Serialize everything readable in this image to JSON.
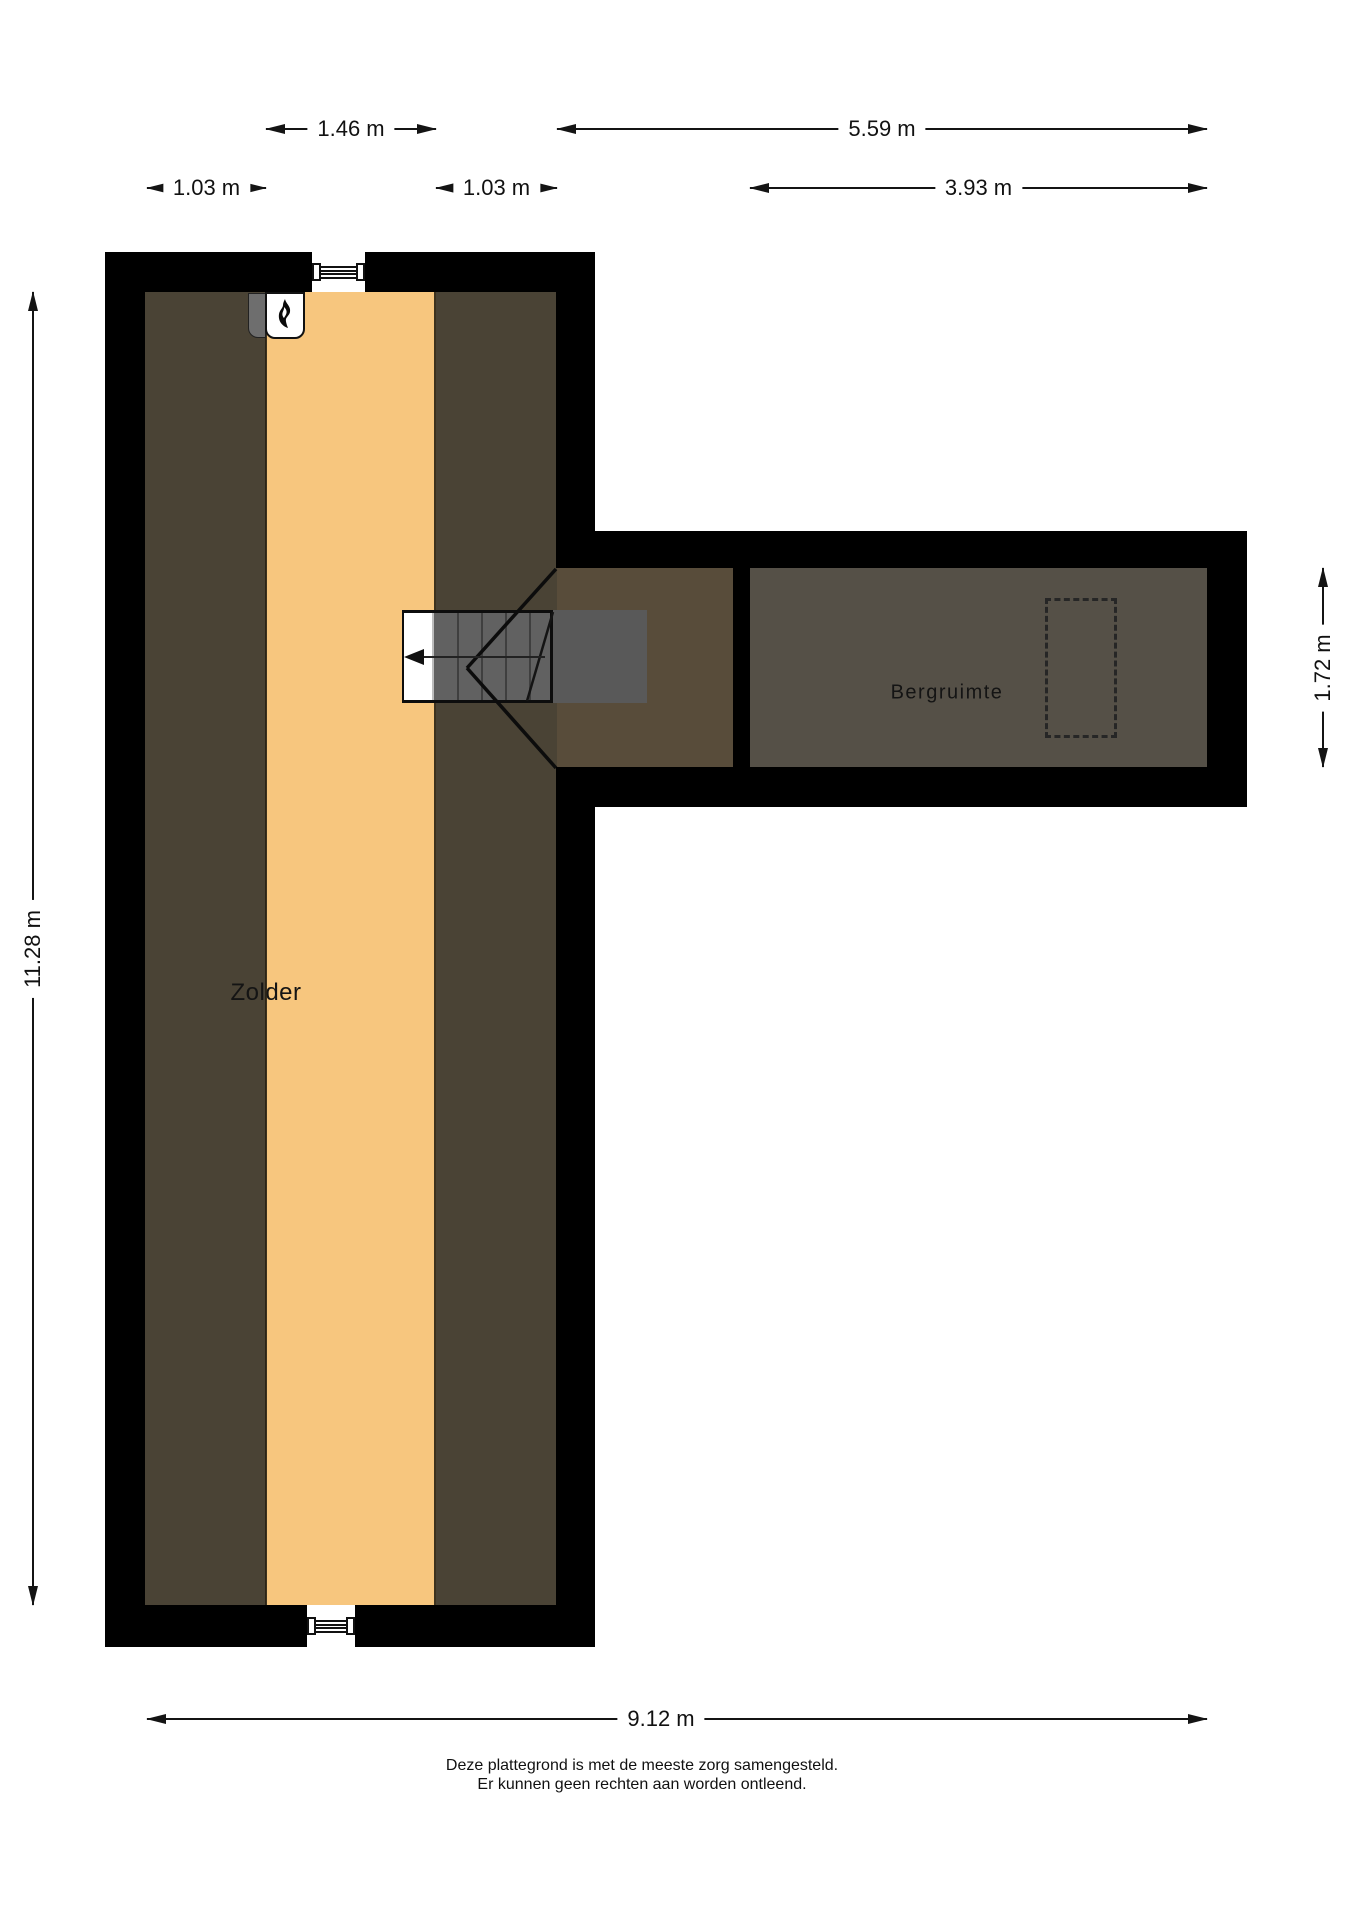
{
  "floorplan": {
    "rooms": {
      "zolder": "Zolder",
      "bergruimte": "Bergruimte"
    },
    "dimensions": {
      "ridge_width": "1.46 m",
      "extension_total_width": "5.59 m",
      "left_strip_width": "1.03 m",
      "right_strip_width": "1.03 m",
      "bergruimte_width": "3.93 m",
      "total_depth": "11.28 m",
      "extension_depth": "1.72 m",
      "total_width": "9.12 m"
    },
    "colors": {
      "wall": "#000000",
      "sloped_zone": "#4a4335",
      "floor_orange": "#f7c67e",
      "corridor_floor": "#584c3a",
      "bergruimte_floor": "#555047",
      "stairwell": "#595959"
    },
    "footer": {
      "line1": "Deze plattegrond is met de meeste zorg samengesteld.",
      "line2": "Er kunnen geen rechten aan worden ontleend."
    }
  }
}
